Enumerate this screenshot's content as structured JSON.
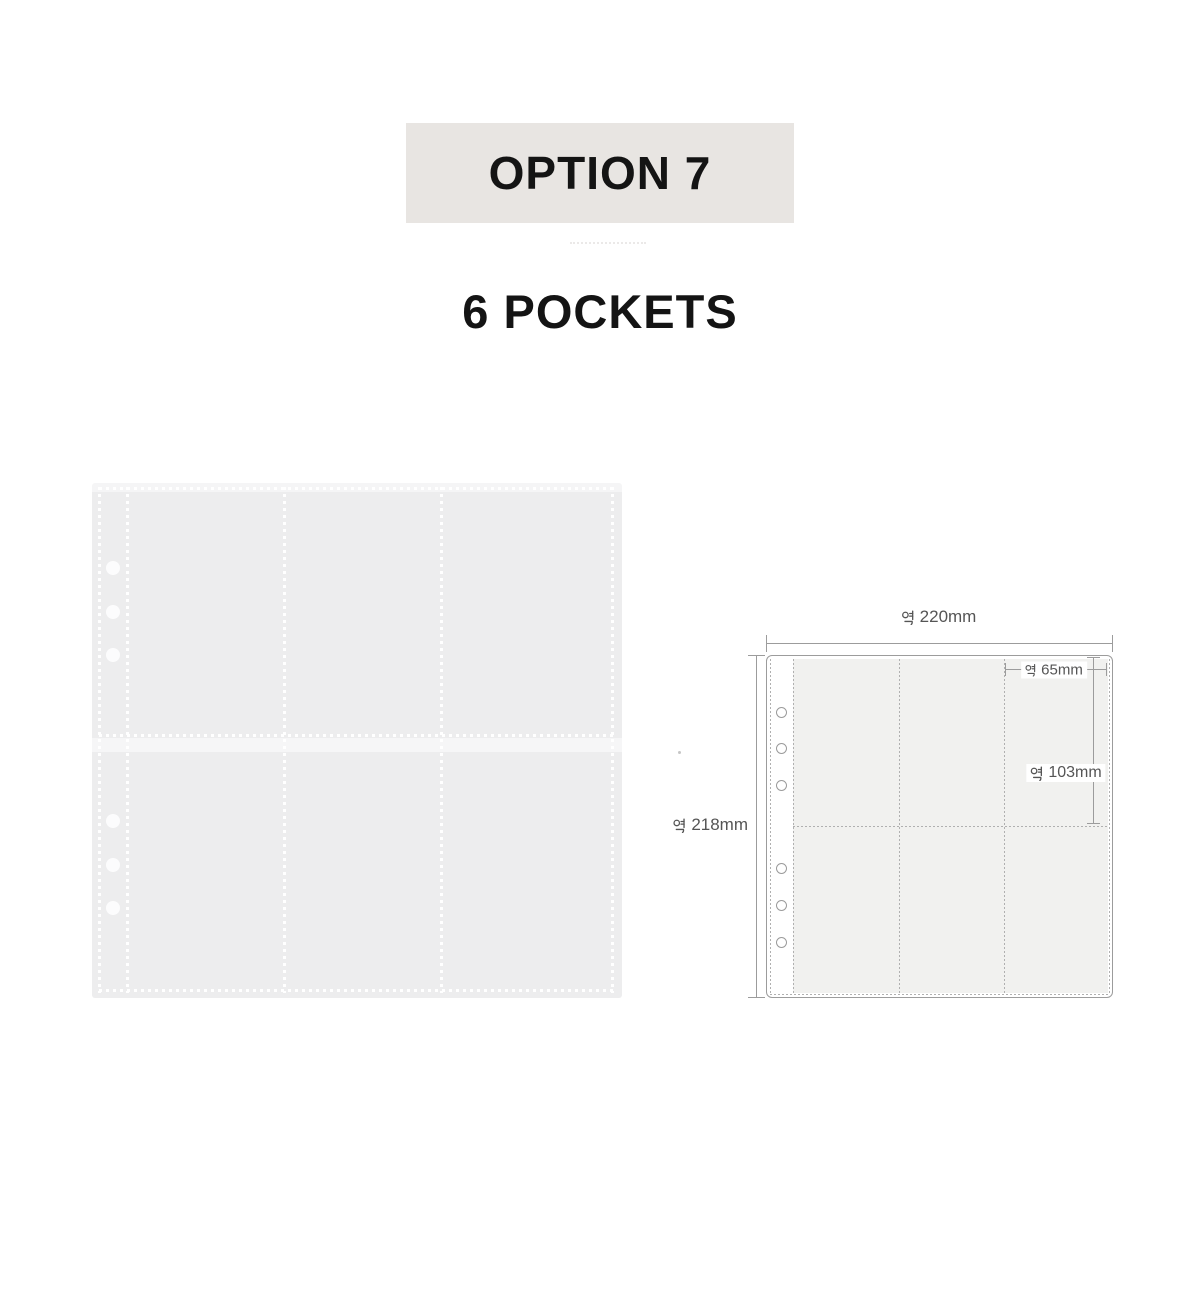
{
  "header": {
    "option_label": "OPTION 7",
    "subtitle": "6 POCKETS",
    "badge_background": "#e8e5e2",
    "text_color": "#141414"
  },
  "product_photo": {
    "description": "transparent 6-pocket binder refill sheet, 2 rows x 3 columns, 6 binding holes on left strip",
    "rows": 2,
    "columns": 3,
    "hole_count": 6,
    "sheet_color": "#ededee",
    "stitch_color": "#ffffff"
  },
  "diagram": {
    "description": "dimension diagram of 6-pocket sheet",
    "rows": 2,
    "columns": 3,
    "hole_count": 6,
    "line_color": "#9c9c9c",
    "label_color": "#555555",
    "pocket_fill": "#f1f1ef",
    "dimensions": {
      "width": {
        "label": "약 220mm",
        "value": "220mm"
      },
      "height": {
        "label": "약 218mm",
        "value": "218mm"
      },
      "pocket_width": {
        "label": "약 65mm",
        "value": "65mm"
      },
      "pocket_height": {
        "label": "약 103mm",
        "value": "103mm"
      }
    }
  }
}
